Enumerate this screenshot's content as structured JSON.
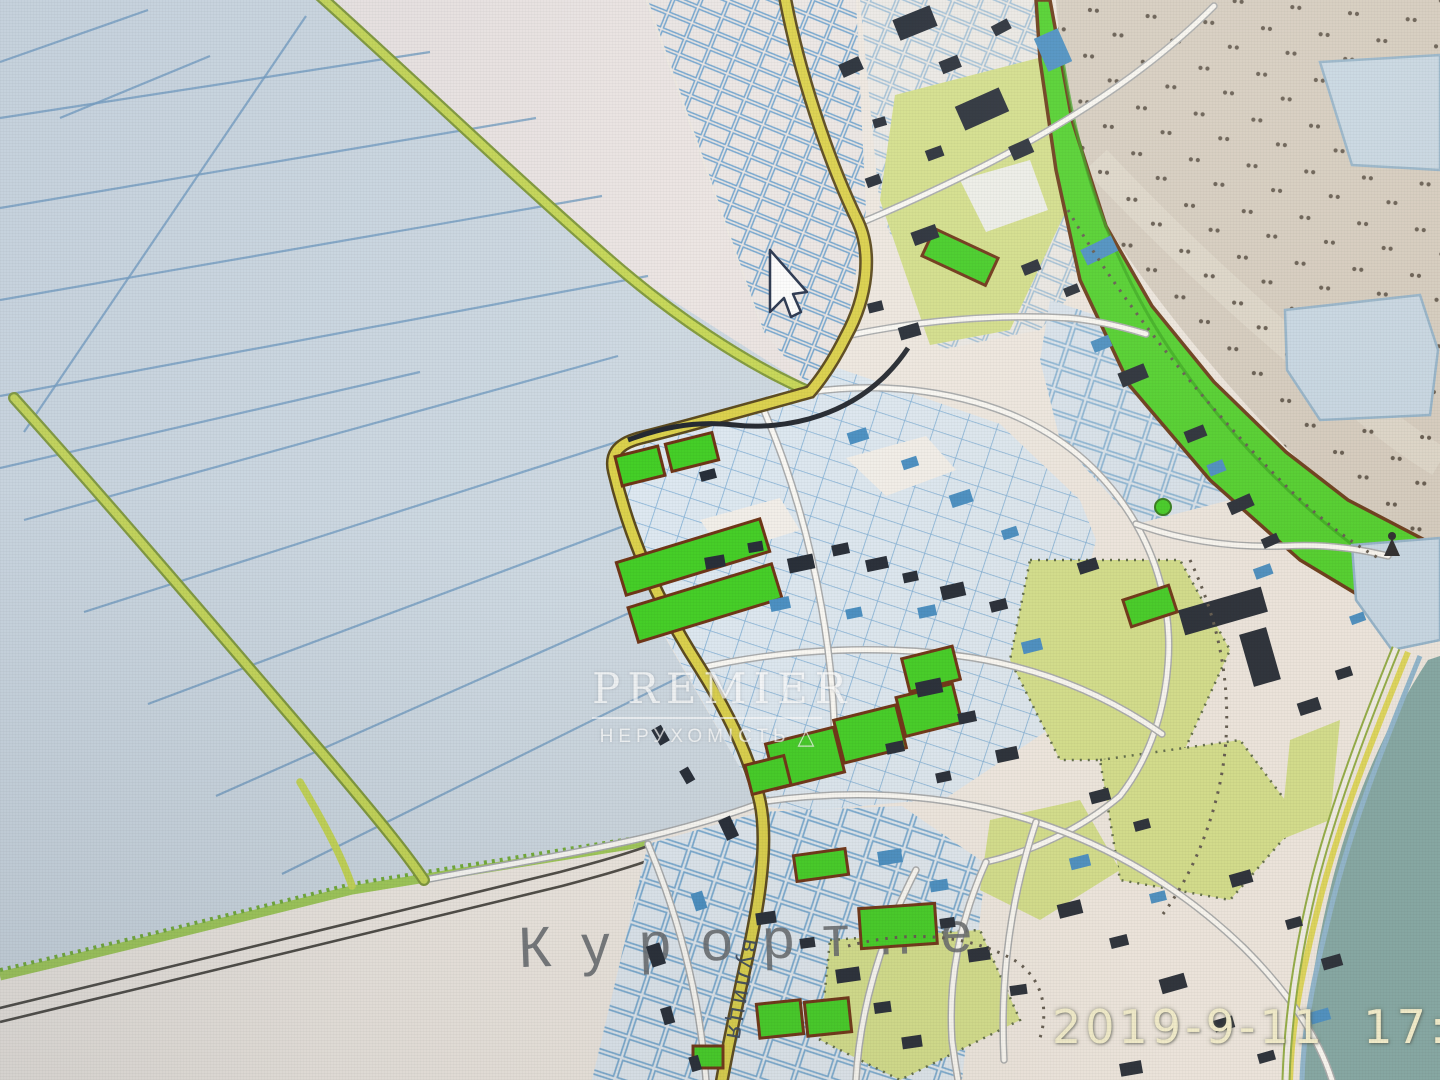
{
  "map": {
    "place_label": "Курортне",
    "street_label": "вулиця",
    "watermark": {
      "title": "PREMIER",
      "subtitle": "НЕРУХОМІСТЬ",
      "logo_glyph": "△"
    },
    "timestamp": "2019-9-11  17:48",
    "icons": [
      "mouse-cursor-icon",
      "monument-icon",
      "triangle-logo-icon"
    ],
    "legend": {
      "field_fill": "#ccd8e3",
      "field_line": "#6f9ec4",
      "urban_base": "#efe9e1",
      "road_yellow": "#ddd23e",
      "rural_road": "#c6d84a",
      "parcel_fill": "#dde9f3",
      "parcel_line": "#74abd6",
      "building_dark": "#222a36",
      "building_blue": "#418fc8",
      "green_parcel": "#38d217",
      "green_parcel_border": "#70300f",
      "vegetation": "#d3e084",
      "park_strip": "#44d61d",
      "sand": "#d7cec1",
      "sea": "#7ea7a5",
      "pond": "#c6daea",
      "label_color": "#64686d"
    }
  }
}
